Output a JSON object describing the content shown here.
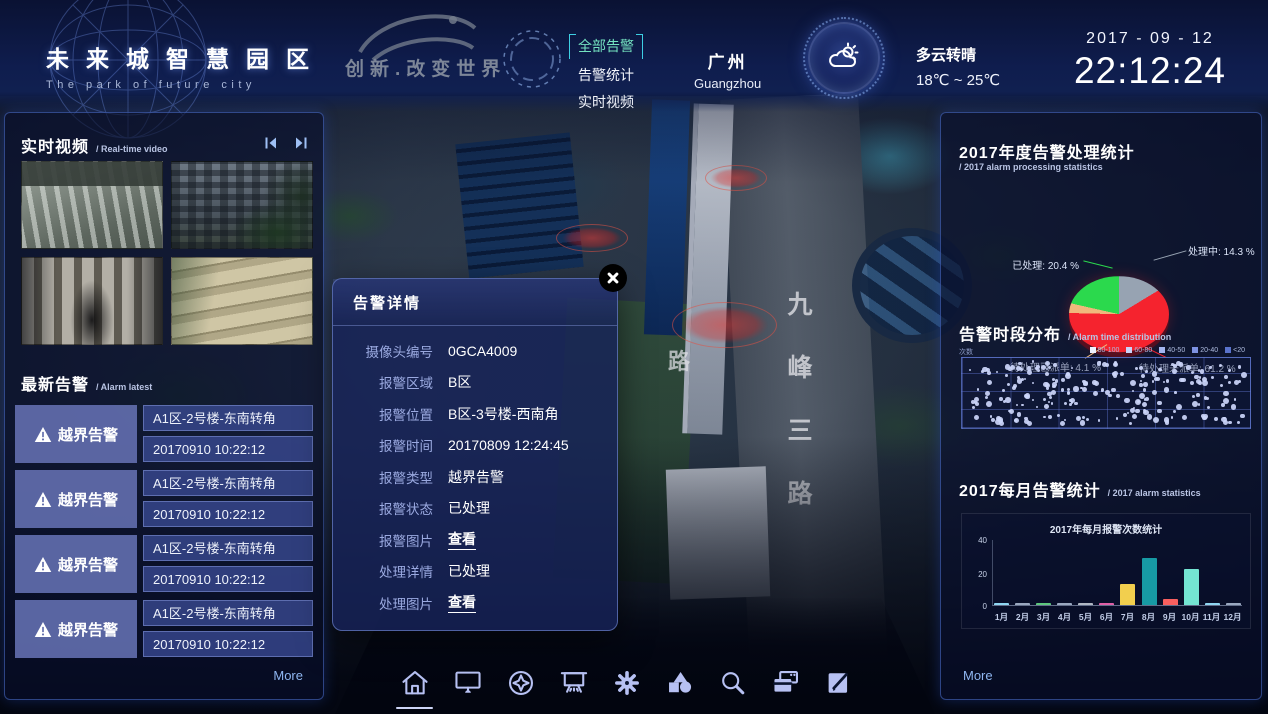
{
  "header": {
    "brand_title": "未来城智慧园区",
    "brand_subtitle": "The park of future city",
    "logo_slogan": "创新.改变世界",
    "nav_all_alarms": "全部告警",
    "nav_alarm_stats": "告警统计",
    "nav_realtime_video": "实时视频",
    "city_cn": "广州",
    "city_en": "Guangzhou",
    "weather_desc": "多云转晴",
    "weather_temp": "18℃ ~ 25℃",
    "date": "2017 - 09 - 12",
    "time": "22:12:24"
  },
  "left_panel": {
    "video_title": "实时视频",
    "video_subtitle": "/ Real-time video",
    "alarm_title": "最新告警",
    "alarm_subtitle": "/ Alarm latest",
    "alarms": [
      {
        "type": "越界告警",
        "location": "A1区-2号楼-东南转角",
        "time": "20170910 10:22:12"
      },
      {
        "type": "越界告警",
        "location": "A1区-2号楼-东南转角",
        "time": "20170910 10:22:12"
      },
      {
        "type": "越界告警",
        "location": "A1区-2号楼-东南转角",
        "time": "20170910 10:22:12"
      },
      {
        "type": "越界告警",
        "location": "A1区-2号楼-东南转角",
        "time": "20170910 10:22:12"
      }
    ],
    "more_label": "More"
  },
  "modal": {
    "title": "告警详情",
    "rows": [
      {
        "label": "摄像头编号",
        "value": "0GCA4009"
      },
      {
        "label": "报警区域",
        "value": "B区"
      },
      {
        "label": "报警位置",
        "value": "B区-3号楼-西南角"
      },
      {
        "label": "报警时间",
        "value": "20170809 12:24:45"
      },
      {
        "label": "报警类型",
        "value": "越界告警"
      },
      {
        "label": "报警状态",
        "value": "已处理"
      },
      {
        "label": "报警图片",
        "value": "查看"
      },
      {
        "label": "处理详情",
        "value": "已处理"
      },
      {
        "label": "处理图片",
        "value": "查看"
      }
    ]
  },
  "map": {
    "road_label": "九峰三路",
    "road_label_left": "路"
  },
  "right_panel": {
    "s1_title": "2017年度告警处理统计",
    "s1_subtitle": "/ 2017 alarm processing statistics",
    "s2_title": "告警时段分布",
    "s2_subtitle": "/ Alarm time distribution",
    "s3_title": "2017每月告警统计",
    "s3_subtitle": "/ 2017 alarm statistics",
    "more_label": "More"
  },
  "chart_data": [
    {
      "type": "pie",
      "title": "2017年度告警处理统计",
      "slices_clockwise_from_top": [
        {
          "label": "处理中",
          "value": 14.3,
          "color": "#97a3b2"
        },
        {
          "label": "待处理未派单",
          "value": 61.2,
          "color": "#f5232e"
        },
        {
          "label": "待处理已派单",
          "value": 4.1,
          "color": "#f0b87c"
        },
        {
          "label": "已处理",
          "value": 20.4,
          "color": "#2bd94d"
        }
      ],
      "labels": [
        {
          "text": "已处理: 20.4 %",
          "pos": "tl"
        },
        {
          "text": "处理中: 14.3 %",
          "pos": "tr"
        },
        {
          "text": "待处理已派单: 4.1 %",
          "pos": "ml"
        },
        {
          "text": "待处理未派单: 61.2 %",
          "pos": "br"
        }
      ]
    },
    {
      "type": "scatter",
      "title": "告警时段分布",
      "axis_label": "次数",
      "legend": [
        "80-100",
        "60-80",
        "40-50",
        "20-40",
        "<20"
      ],
      "legend_colors": [
        "#eef2ff",
        "#c9d4fa",
        "#a3b5f0",
        "#7d92e2",
        "#5a73cc"
      ],
      "approx_points": 235,
      "point_color": "#ccd6fa",
      "grid": {
        "cols": 6,
        "rows": 4
      }
    },
    {
      "type": "bar",
      "inner_title": "2017年每月报警次数统计",
      "categories": [
        "1月",
        "2月",
        "3月",
        "4月",
        "5月",
        "6月",
        "7月",
        "8月",
        "9月",
        "10月",
        "11月",
        "12月"
      ],
      "values": [
        1,
        1,
        1,
        1,
        1,
        1,
        13,
        29,
        4,
        22,
        1,
        1
      ],
      "colors": [
        "#8fd6f2",
        "#9aa8c0",
        "#5ec87e",
        "#9aa8c0",
        "#b0b8c4",
        "#e060a8",
        "#f2cf4e",
        "#179aa4",
        "#f85f5f",
        "#74e5d2",
        "#8fd6f2",
        "#9aa8c0"
      ],
      "ylim": [
        0,
        40
      ],
      "yticks": [
        "40",
        "20",
        "0"
      ]
    }
  ],
  "dock": {
    "icons": [
      "home-icon",
      "monitor-icon",
      "compass-icon",
      "screen-icon",
      "gear-icon",
      "shapes-icon",
      "search-icon",
      "cards-icon",
      "edit-icon"
    ],
    "active_icon": "home-icon"
  },
  "colors": {
    "accent_cyan": "#3ecfe3",
    "nav_active_green": "#74e2c0",
    "panel_border_blue": "#567de6",
    "link_blue": "#8fb6f0",
    "dock_icon": "#b7c1f3",
    "alarm_zone_red": "#ff3c32"
  }
}
